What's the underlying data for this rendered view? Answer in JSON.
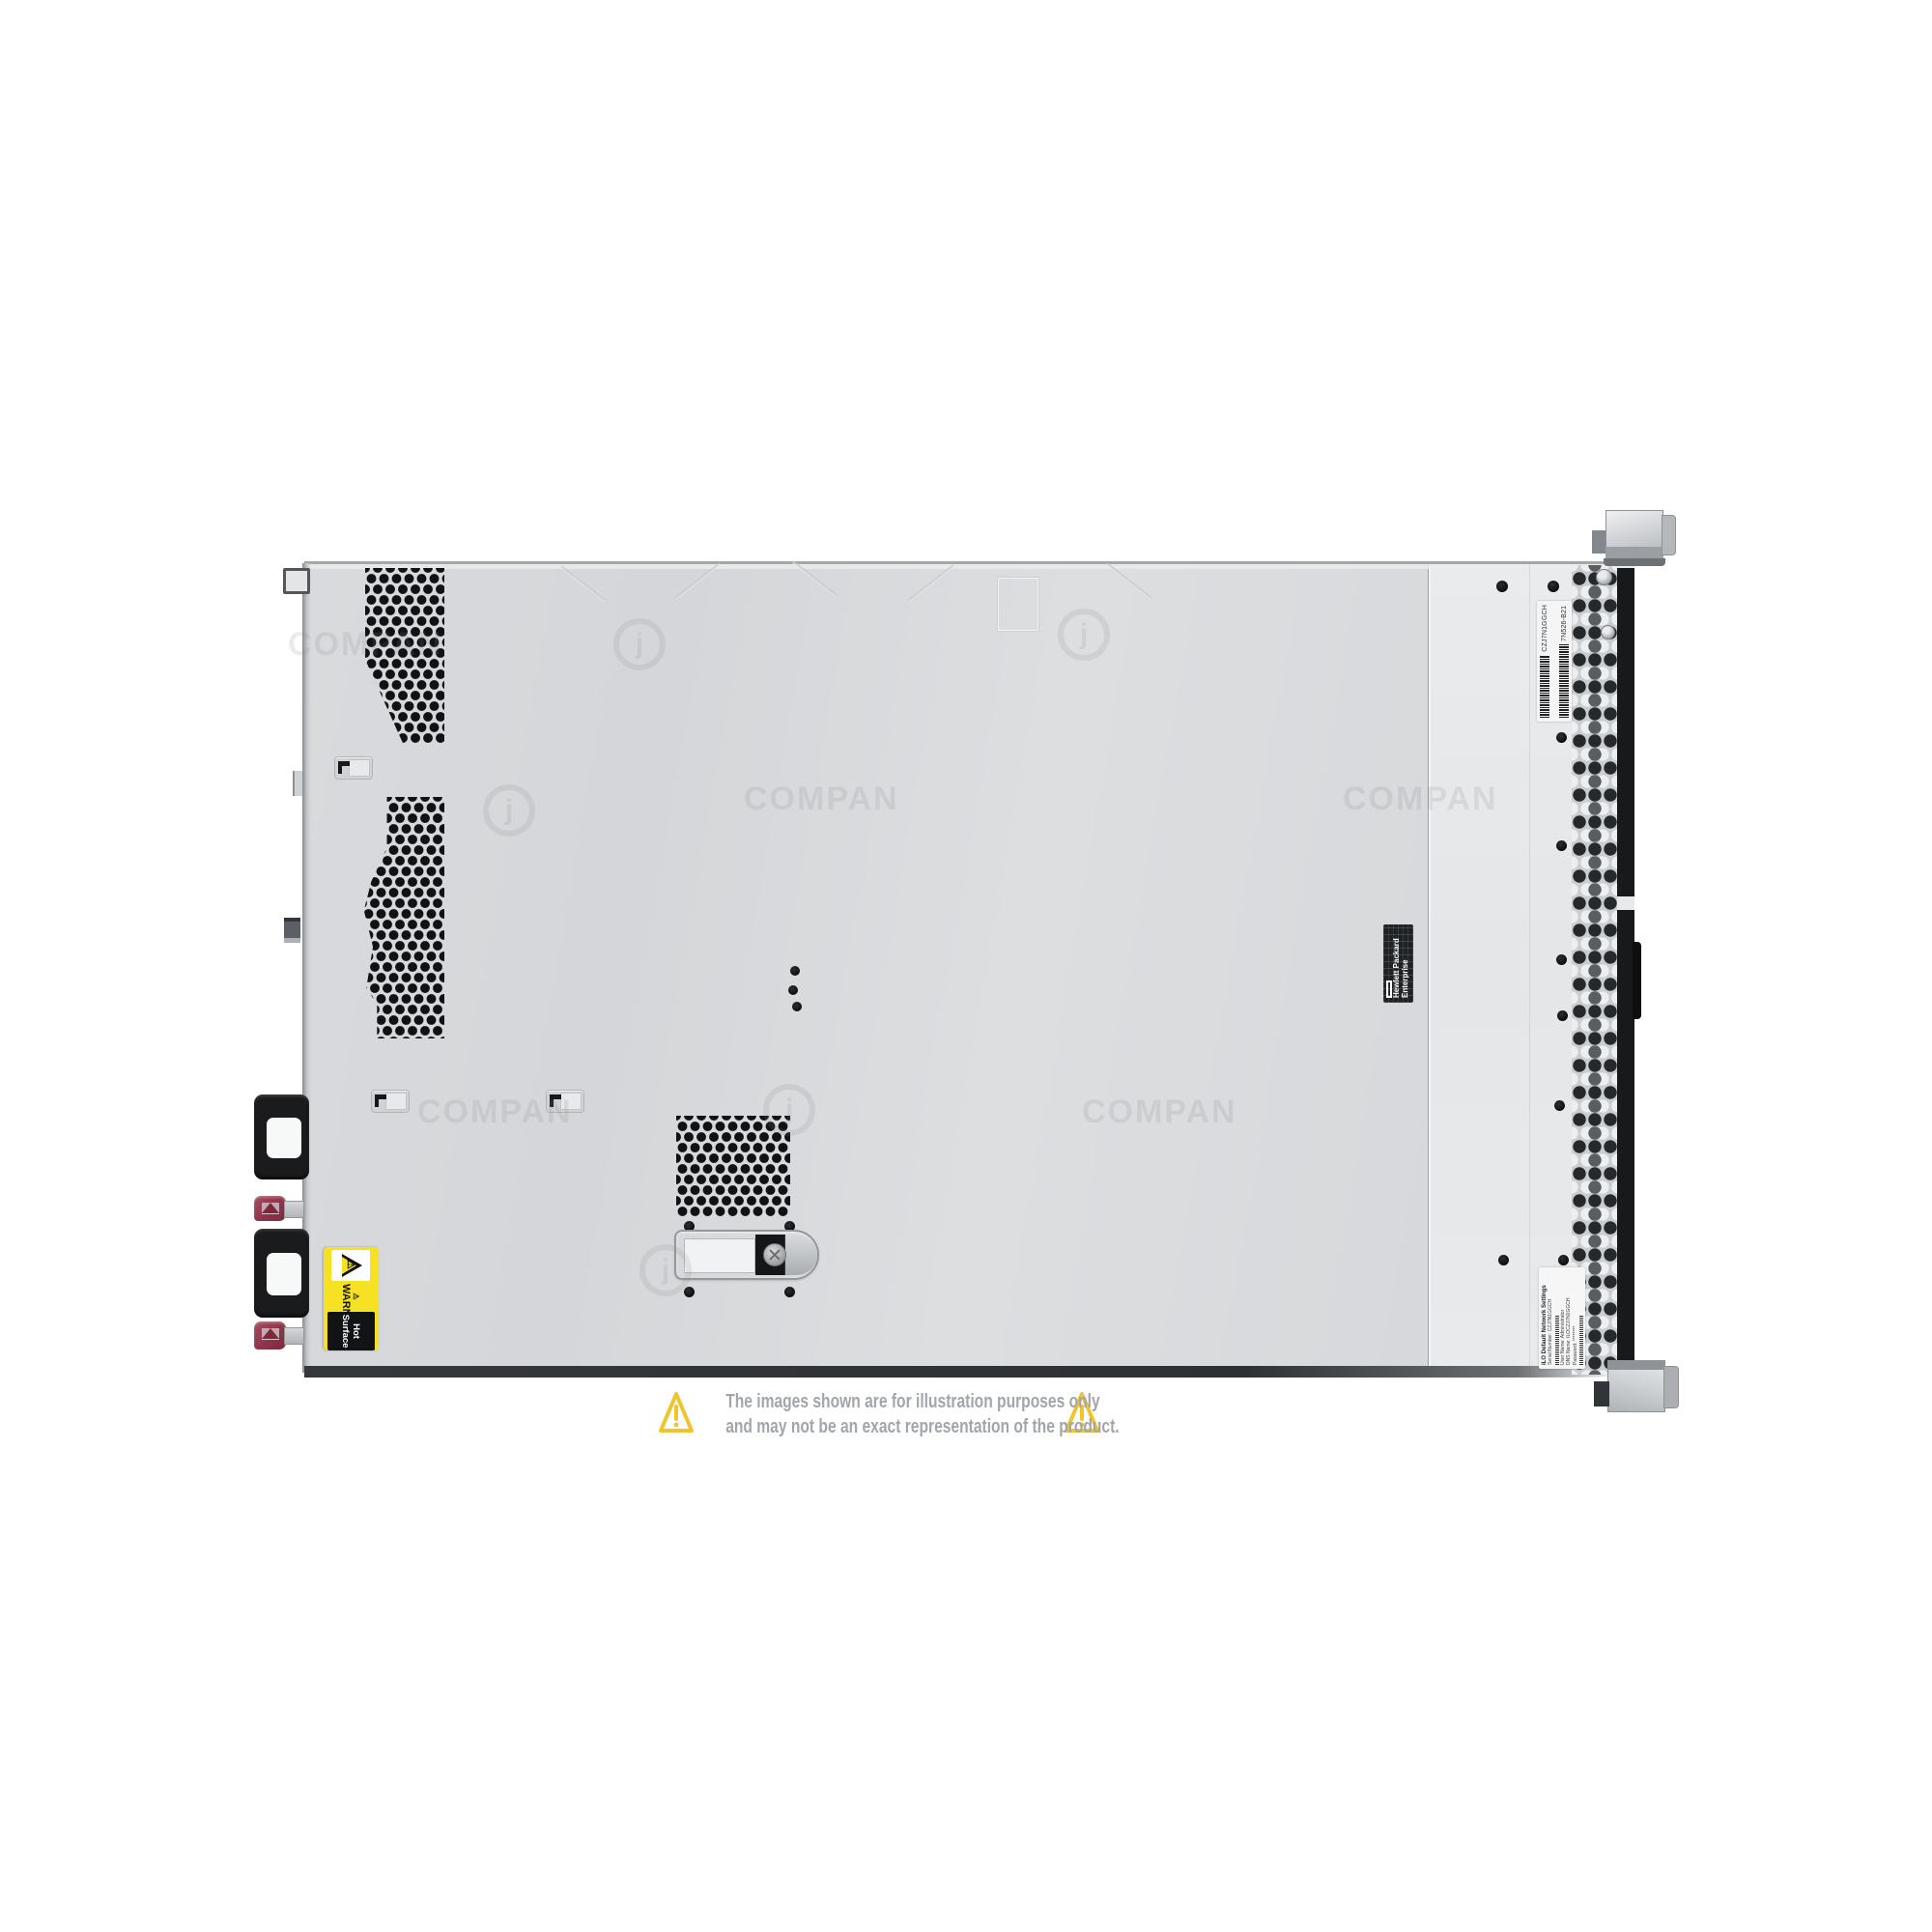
{
  "page": {
    "background": "#ffffff"
  },
  "watermark": {
    "text": "COMPAN",
    "logo": "j"
  },
  "disclaimer": {
    "line1": "The images shown are for illustration purposes only",
    "line2": "and may not be an exact representation of the product.",
    "icon_name": "warning-triangle-icon",
    "triangle_color": "#f0c42c",
    "text_color": "#a2a6aa"
  },
  "server": {
    "colors": {
      "cover_gray": "#d7d9dc",
      "front_gray": "#e7e9eb",
      "bezel_black": "#17191b",
      "psu_latch_maroon": "#90334a",
      "warning_yellow": "#f6e222"
    },
    "warning_label": {
      "prefix_icon": "⚠",
      "warning": "WARNING:",
      "message": "Hot Surface"
    },
    "hpe_label": {
      "line1": "Hewlett Packard",
      "line2": "Enterprise"
    },
    "service_label": {
      "serial": "CZJ7N1GGCH",
      "part": "7N526-B21"
    },
    "ilo_label": {
      "title": "iLO Default Network Settings",
      "serial": "Serial Number: CZJ7N1GGCH",
      "user": "User Name: Administrator",
      "dns": "DNS Name: ILOCZJ7N1GGCH",
      "password": "Password: ********"
    }
  }
}
